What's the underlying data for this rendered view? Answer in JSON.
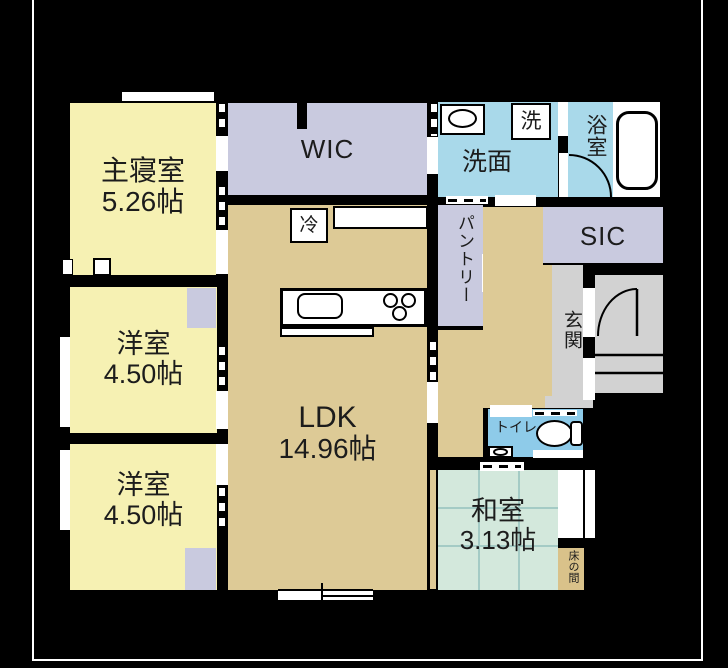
{
  "rooms": {
    "master_bedroom": {
      "name": "主寝室",
      "size": "5.26帖"
    },
    "wic": {
      "name": "WIC"
    },
    "washroom": {
      "name": "洗面"
    },
    "washer": {
      "name": "洗"
    },
    "bathroom": {
      "name": "浴室"
    },
    "sic": {
      "name": "SIC"
    },
    "pantry": {
      "name": "パントリー"
    },
    "entrance": {
      "name": "玄関"
    },
    "refrigerator": {
      "name": "冷"
    },
    "western_room_1": {
      "name": "洋室",
      "size": "4.50帖"
    },
    "western_room_2": {
      "name": "洋室",
      "size": "4.50帖"
    },
    "ldk": {
      "name": "LDK",
      "size": "14.96帖"
    },
    "toilet": {
      "name": "トイレ"
    },
    "japanese_room": {
      "name": "和室",
      "size": "3.13帖"
    },
    "tokonoma": {
      "name": "床の間"
    }
  },
  "colors": {
    "room_yellow": "#f6f1b3",
    "closet_lavender": "#c9cadf",
    "ldk_tan": "#ddca96",
    "wet_area_blue": "#a9d9ea",
    "toilet_blue": "#8ecbe9",
    "tatami_green": "#d3e8dc",
    "entrance_gray": "#d2d2d2",
    "tokonoma_tan": "#d9c28a",
    "wall_black": "#000000"
  }
}
